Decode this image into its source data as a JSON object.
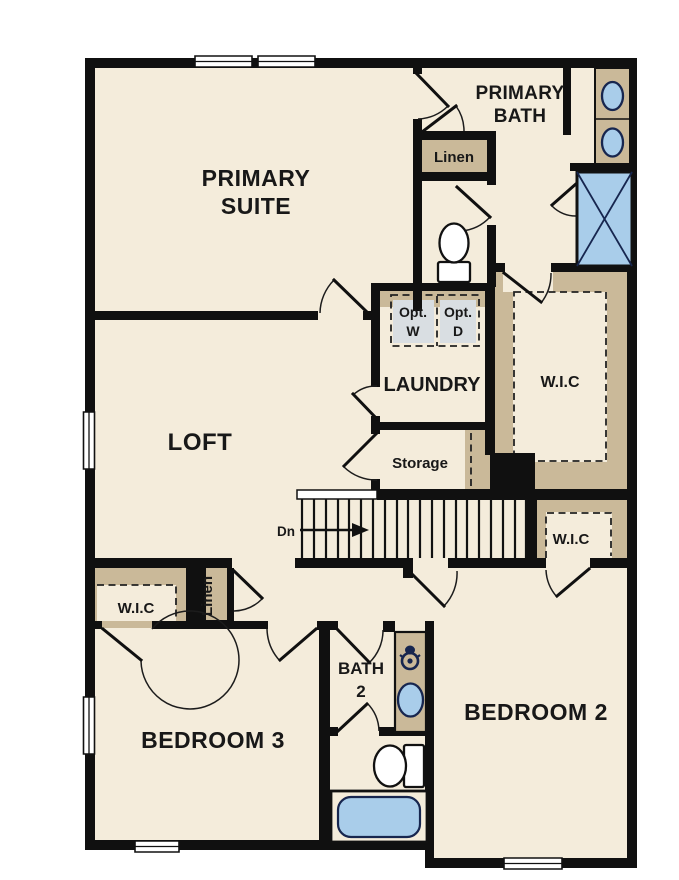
{
  "meta": {
    "drawing_type": "residential floor plan",
    "floor": "upper level"
  },
  "colors": {
    "floor": "#f4ecdb",
    "wall": "#101010",
    "casework_tan": "#cab999",
    "fixture_blue": "#a9cdea",
    "fixture_outline_navy": "#17264f",
    "optional_appliance_fill": "#d9dee2",
    "label_text": "#181818"
  },
  "rooms": {
    "primary_suite": {
      "name": [
        "PRIMARY",
        "SUITE"
      ]
    },
    "primary_bath": {
      "name": [
        "PRIMARY",
        "BATH"
      ]
    },
    "bath_linen": {
      "name": "Linen"
    },
    "laundry": {
      "name": "LAUNDRY",
      "opt_washer": [
        "Opt.",
        "W"
      ],
      "opt_dryer": [
        "Opt.",
        "D"
      ]
    },
    "wic_primary": {
      "name": "W.I.C"
    },
    "loft": {
      "name": "LOFT"
    },
    "storage": {
      "name": "Storage"
    },
    "stairs": {
      "direction": "Dn"
    },
    "wic_bedroom2": {
      "name": "W.I.C"
    },
    "wic_bedroom3": {
      "name": "W.I.C"
    },
    "hall_linen": {
      "name": "Linen"
    },
    "bedroom3": {
      "name": "BEDROOM 3"
    },
    "bath2": {
      "name": [
        "BATH",
        "2"
      ]
    },
    "bedroom2": {
      "name": "BEDROOM 2"
    }
  }
}
